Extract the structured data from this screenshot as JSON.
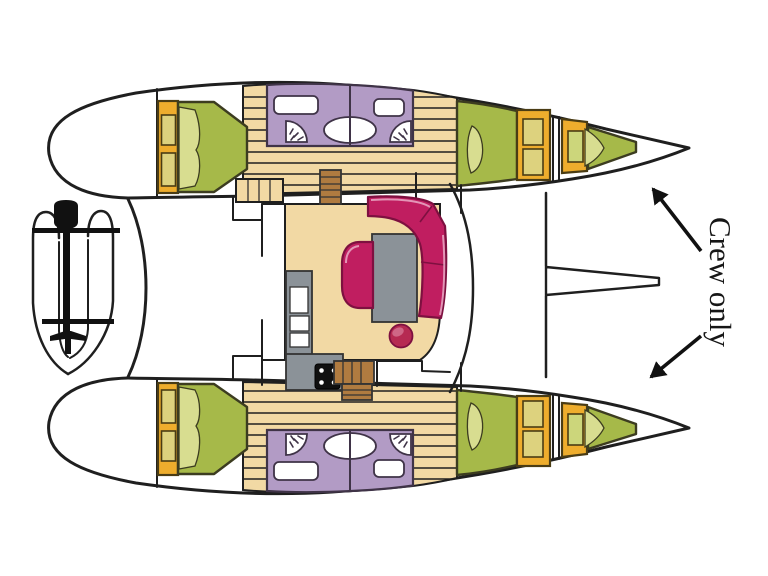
{
  "annotation": {
    "crew_only": "Crew only"
  },
  "vessel": {
    "view": "catamaran-deck-plan",
    "areas": [
      "port-hull",
      "starboard-hull",
      "salon",
      "galley",
      "cockpit",
      "foredeck-trampoline",
      "aft-cabin",
      "forward-cabin",
      "bathroom",
      "crew-forepeak",
      "dinghy-on-davits"
    ]
  },
  "colors": {
    "line": "#1f1f1f",
    "black": "#111111",
    "bed_green": "#a6b949",
    "bed_light": "#d8dd90",
    "bed_line": "#3c3c20",
    "cabinet_yellow": "#eead2d",
    "cabinet_inner": "#ddd27e",
    "crew_inner": "#ccd67b",
    "cab_line": "#4a3c14",
    "bathroom_purple": "#b29bc5",
    "bath_line": "#3f3347",
    "floor_tan": "#f2d9a4",
    "steps_brown": "#b07b40",
    "sofa_magenta": "#c01e60",
    "sofa_dark": "#7e1040",
    "sofa_light": "#e9aac6",
    "table_gray": "#8b9298",
    "gray_line": "#333333",
    "pouf_red": "#b62a52",
    "pouf_light": "#d4718f"
  }
}
